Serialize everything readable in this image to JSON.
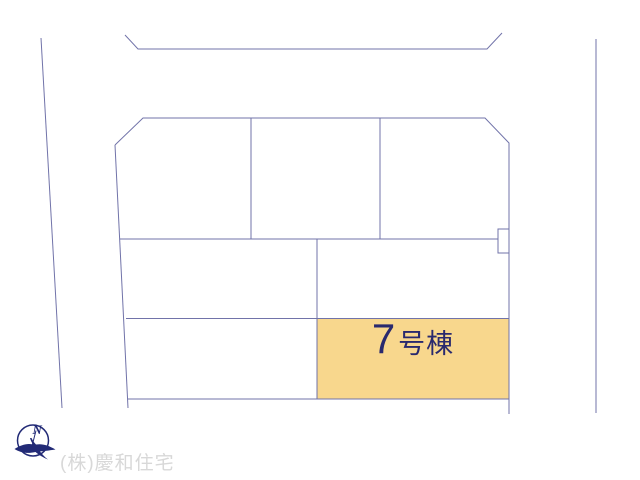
{
  "colors": {
    "background": "#ffffff",
    "line": "#7173a9",
    "navy": "#222a76",
    "label_text": "#29296e",
    "highlight_fill": "#f8d78d",
    "company_text": "#d8d8d8"
  },
  "parcel": {
    "number": "7",
    "suffix": "号棟",
    "full_label": "7号棟"
  },
  "compass": {
    "north_label": "N"
  },
  "footer": {
    "company_name": "(株)慶和住宅"
  }
}
